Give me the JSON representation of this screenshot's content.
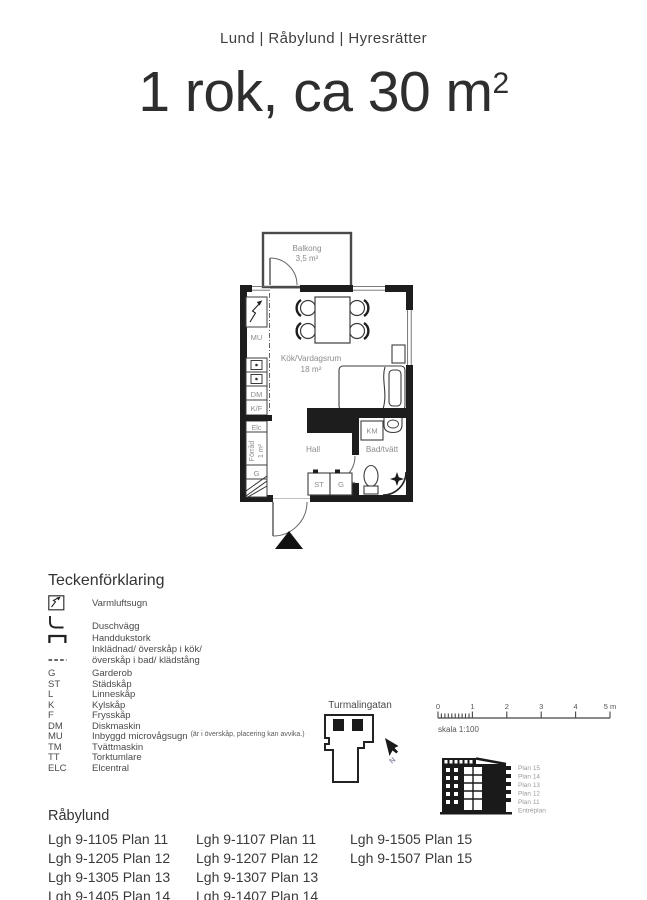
{
  "header": {
    "location_line": "Lund | Råbylund | Hyresrätter"
  },
  "title": {
    "text": "1 rok, ca 30 m",
    "sup": "2"
  },
  "floorplan": {
    "balcony": "Balkong",
    "balcony_area": "3,5 m²",
    "room": "Kök/Vardagsrum",
    "room_area": "18 m²",
    "hall": "Hall",
    "bath": "Bad/tvätt",
    "km": "KM",
    "mu": "MU",
    "dm": "DM",
    "kf": "K/F",
    "elc": "Elc",
    "storage": "Förråd",
    "storage_area": "1 m²",
    "wardrobe_kitchen": "G",
    "cleaning_closet": "ST",
    "wardrobe_hall": "G"
  },
  "legend": {
    "heading": "Teckenförklaring",
    "items": [
      {
        "abbr": "",
        "label": "Varmluftsugn"
      },
      {
        "abbr": "",
        "label": "Duschvägg"
      },
      {
        "abbr": "",
        "label": "Handdukstork"
      },
      {
        "abbr": "",
        "label": "Inklädnad/ överskåp i kök/"
      },
      {
        "abbr": "",
        "label": "överskåp i bad/ klädstång"
      },
      {
        "abbr": "G",
        "label": "Garderob"
      },
      {
        "abbr": "ST",
        "label": "Städskåp"
      },
      {
        "abbr": "L",
        "label": "Linneskåp"
      },
      {
        "abbr": "K",
        "label": "Kylskåp"
      },
      {
        "abbr": "F",
        "label": "Frysskåp"
      },
      {
        "abbr": "DM",
        "label": "Diskmaskin"
      },
      {
        "abbr": "MU",
        "label": "Inbyggd microvågsugn",
        "note": "(är i överskåp, placering kan avvika.)"
      },
      {
        "abbr": "TM",
        "label": "Tvättmaskin"
      },
      {
        "abbr": "TT",
        "label": "Torktumlare"
      },
      {
        "abbr": "ELC",
        "label": "Elcentral"
      }
    ]
  },
  "siteplan": {
    "street": "Turmalingatan",
    "north": "N"
  },
  "scalebar": {
    "ticks": [
      "0",
      "1",
      "2",
      "3",
      "4",
      "5 m"
    ],
    "caption": "skala 1:100"
  },
  "elevation": {
    "floors": [
      "Plan 15",
      "Plan 14",
      "Plan 13",
      "Plan 12",
      "Plan 11",
      "Entréplan"
    ]
  },
  "apartments": {
    "heading": "Råbylund",
    "columns": [
      [
        "Lgh 9-1105 Plan 11",
        "Lgh 9-1205 Plan 12",
        "Lgh 9-1305 Plan 13",
        "Lgh 9-1405 Plan 14"
      ],
      [
        "Lgh 9-1107 Plan 11",
        "Lgh 9-1207 Plan 12",
        "Lgh 9-1307 Plan 13",
        "Lgh 9-1407 Plan 14"
      ],
      [
        "Lgh 9-1505 Plan 15",
        "Lgh 9-1507 Plan 15"
      ]
    ]
  },
  "colors": {
    "ink": "#383838",
    "wall": "#1d1d1d",
    "plan_label": "#8b8b8b",
    "floor_label": "#9a9a9a"
  }
}
